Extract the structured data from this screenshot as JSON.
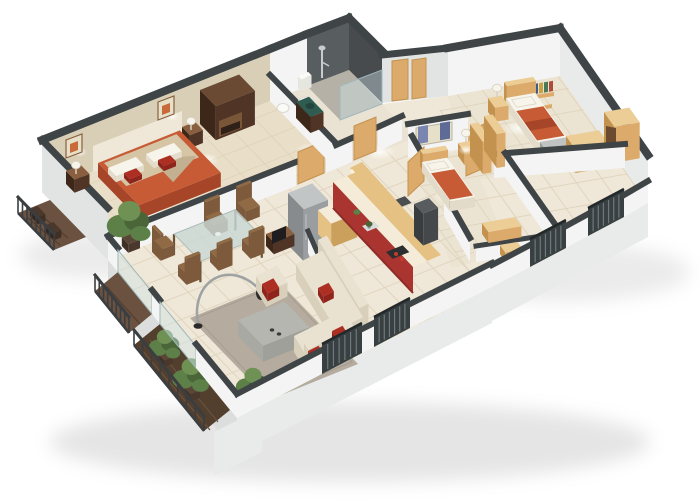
{
  "meta": {
    "kind": "3d-floor-plan-render",
    "description": "Isometric cutaway 3D rendering of a three-bedroom apartment floor plan on a white background",
    "style": "tall back walls, low cut front walls, dark wall caps"
  },
  "rooms": [
    {
      "id": "master-bedroom",
      "furniture": [
        "double-bed",
        "nightstand-left",
        "nightstand-right",
        "table-lamps",
        "wardrobe",
        "wall-art-frames",
        "headboard-panel"
      ]
    },
    {
      "id": "bathroom",
      "furniture": [
        "walk-in-shower",
        "shower-glass",
        "toilet",
        "bidet",
        "green-top-vanity"
      ]
    },
    {
      "id": "hallway",
      "furniture": [
        "entrance-doors",
        "doormat",
        "wall-art-panel"
      ]
    },
    {
      "id": "kitchen",
      "furniture": [
        "refrigerator",
        "l-shaped-red-counter",
        "upper-cabinets",
        "cooktop",
        "sink",
        "oven-column",
        "counter-plants",
        "half-wall"
      ]
    },
    {
      "id": "living-dining",
      "furniture": [
        "glass-dining-table",
        "six-wood-chairs",
        "area-rug",
        "gray-coffee-table",
        "corner-sofa",
        "armchair",
        "red-cushions",
        "arc-floor-lamp",
        "tv-sideboard",
        "potted-plant"
      ]
    },
    {
      "id": "bedroom-2",
      "furniture": [
        "single-bed",
        "nightstand",
        "table-lamp",
        "wardrobe-panels",
        "low-bench"
      ]
    },
    {
      "id": "bedroom-3",
      "furniture": [
        "single-bed",
        "foot-bench",
        "nightstand",
        "book-shelf",
        "dresser",
        "wardrobe"
      ]
    },
    {
      "id": "balcony-upper-left",
      "furniture": [
        "wood-deck",
        "railing",
        "planter-boxes"
      ]
    },
    {
      "id": "balcony-lower-left",
      "furniture": [
        "wood-deck",
        "railing"
      ]
    },
    {
      "id": "terrace-bottom-left",
      "furniture": [
        "wood-deck",
        "railing",
        "potted-plants"
      ]
    }
  ],
  "colors": {
    "background": "#ffffff",
    "wall_top": "#3f4447",
    "wall_face_white": "#f3f4f3",
    "wall_face_shade": "#e2e4e3",
    "back_wall_beige": "#d8cfb6",
    "headboard_panel": "#efe8d8",
    "shower_wall": "#585d60",
    "shower_wall_dark": "#474b4e",
    "shower_floor": "#b5b1a6",
    "glass": "#cfe3e6",
    "floor_cream": "#efe7d7",
    "floor_bedroom": "#e9dfc8",
    "floor_bath": "#eae3d4",
    "floor_wing": "#ece4d2",
    "grout": "#ddd1b9",
    "rug": "#b5ab9e",
    "balcony_wood": "#6a5140",
    "balcony_wood_dark": "#533f2e",
    "railing": "#3a3e41",
    "bed_orange": "#c65b35",
    "bed_orange_dark": "#a64527",
    "blanket_tan": "#d6c5a5",
    "pillow_white": "#f7f4ec",
    "cushion_red": "#ad2f24",
    "wood_dark": "#503526",
    "wood_dark_side": "#3d2719",
    "wood_mid": "#8a5f3f",
    "wood_light": "#dcab6b",
    "wood_light_side": "#c3924f",
    "wood_lighter": "#eccd96",
    "glass_table": "#c9d8d5",
    "chair_wood": "#7c5a3b",
    "chair_wood_top": "#8f6a45",
    "sofa_cream": "#eae2d0",
    "sofa_cream_dark": "#d9d0bc",
    "table_gray": "#b5b6b0",
    "table_gray_dark": "#9fa09a",
    "lamp_black": "#2a2a2a",
    "lamp_arc": "#9ea2a3",
    "kitchen_red": "#a93430",
    "kitchen_red_dark": "#8e2b28",
    "counter_cream": "#f4ebd9",
    "cabinet_wood": "#e5c183",
    "cabinet_wood_dark": "#caa05c",
    "fridge_gray": "#9a9ea0",
    "fridge_gray_dark": "#878b8d",
    "fridge_top": "#c2c5c5",
    "appliance_dark": "#45484b",
    "cooktop_black": "#2c2e30",
    "burner_red": "#c43b2f",
    "vanity_green": "#2f5b50",
    "vanity_green_dark": "#24453d",
    "porcelain": "#fafaf7",
    "porcelain_shade": "#e6e6e0",
    "plant_green": "#5d7f48",
    "plant_green_dark": "#4a6639",
    "plant_green_light": "#6f9254",
    "art_blue": "#7a86b0",
    "art_blue_dark": "#5d6b96",
    "art_cream": "#e6e0c8",
    "art_orange": "#c96a3a",
    "book_red": "#b04a3a",
    "book_blue": "#3f5d8a",
    "book_yellow": "#c8a23f",
    "book_green": "#4a7a55",
    "slab": "#e9ebea",
    "slab_dark": "#dcdedd",
    "window_dark": "#384042",
    "window_slat": "#8a9094",
    "mat_dark": "#4a4e50",
    "glow": "#ffffff"
  }
}
